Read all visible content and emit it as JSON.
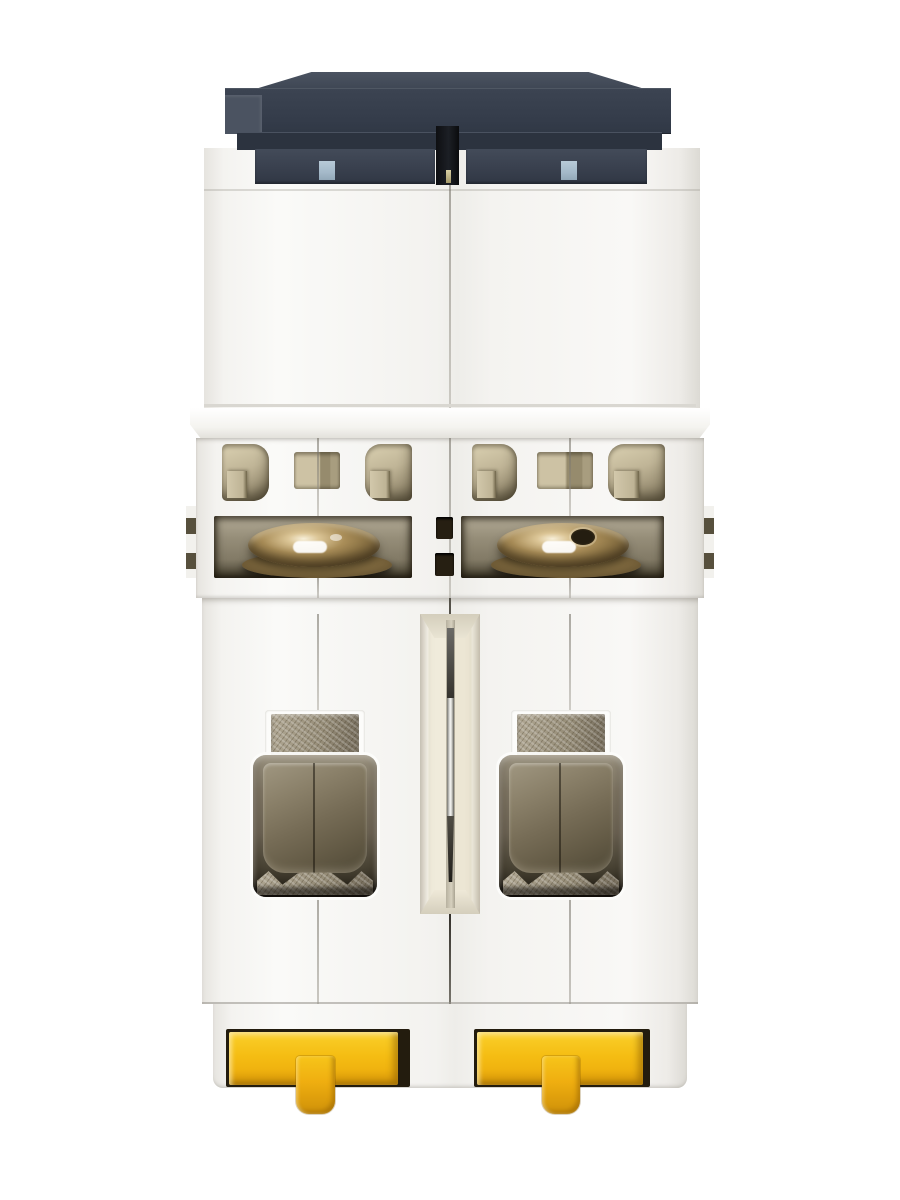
{
  "image": {
    "type": "product-photo",
    "subject": "Two-pole miniature circuit breaker (MCB) photographed from the bottom DIN-rail side on a white background",
    "visible_text": ""
  },
  "palette": {
    "bg": "#ffffff",
    "body_white": "#f5f4f1",
    "cap_top": "#3e4653",
    "cap_face": "#343c4a",
    "cap_face2": "#2c333f",
    "cap_band": "#39404e",
    "cap_light": "#4b5361",
    "slot_black": "#1c1f25",
    "tab_blue": "#a4b9c9",
    "vent_tan": "#c0b597",
    "vent_tan_dark": "#57503d",
    "slot_taupe": "#968e79",
    "brass": "#a98d58",
    "channel_cream": "#f0ebdb",
    "pin_light": "#f4f4f2",
    "metal_tex": "#b1a894",
    "clamp": "#766c56",
    "clip_slot": "#231c0e",
    "clip_yellow": "#f5bd13",
    "clip_dark": "#e0a00c"
  },
  "parts": [
    "dark front cover edge (top)",
    "pole divider slot with pin",
    "upper white housing (two pole halves)",
    "ventilation windows with internal walls",
    "solenoid coil openings with brass coils",
    "central rivet holes",
    "recessed center channel with steel pin",
    "terminal cage openings with clamp and screw foot",
    "textured busbar tabs",
    "yellow DIN-rail release clips with pull tabs"
  ]
}
